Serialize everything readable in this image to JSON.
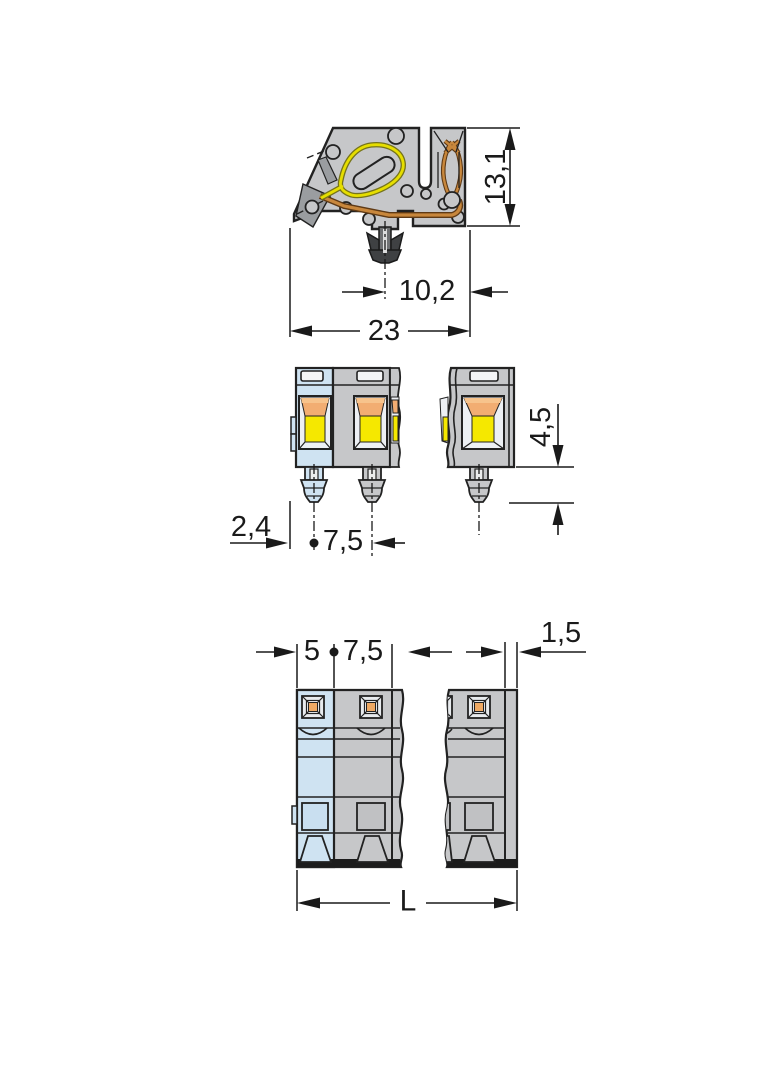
{
  "colors": {
    "background": "#ffffff",
    "body_gray": "#c6c7c9",
    "end_unit_blue": "#cfe3f2",
    "opening_yellow": "#f5e800",
    "funnel_orange": "#f2ad72",
    "conductor_copper": "#c8873c",
    "clamp_spring_yellow": "#e6de00",
    "outline": "#222222",
    "dimension_ink": "#1a1a1a"
  },
  "views": {
    "side_view": {
      "height": "13,1",
      "foot_to_edge": "10,2",
      "depth": "23"
    },
    "front_view": {
      "edge_to_foot": "2,4",
      "foot_pitch": "7,5",
      "foot_length": "4,5"
    },
    "underside_view": {
      "end_width": "5",
      "pole_pitch": "7,5",
      "end_plate": "1,5",
      "total_length": "L"
    }
  }
}
